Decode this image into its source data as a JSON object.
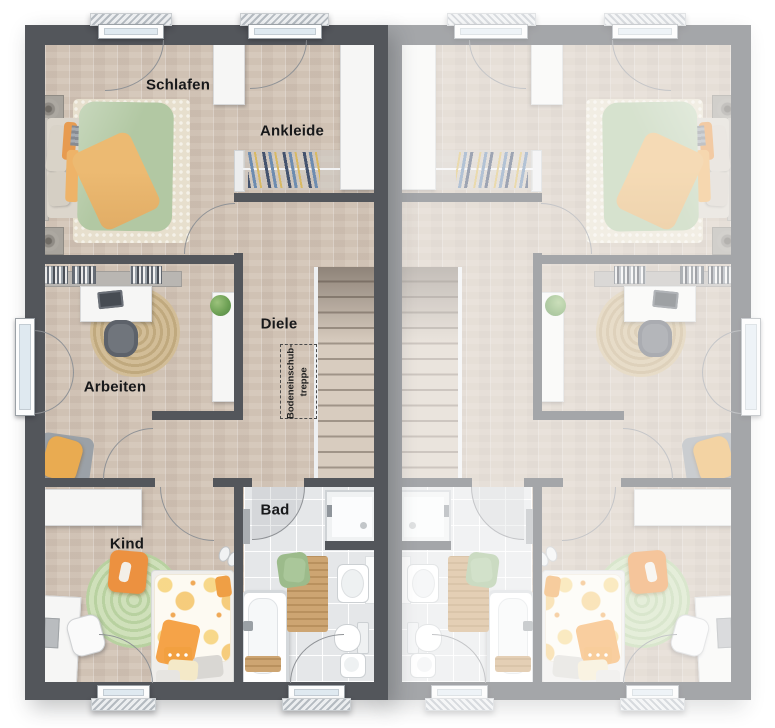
{
  "plan": {
    "room_labels": {
      "schlafen": "Schlafen",
      "ankleide": "Ankleide",
      "diele": "Diele",
      "arbeiten": "Arbeiten",
      "bad": "Bad",
      "kind": "Kind"
    },
    "attic_hatch": {
      "line1": "Bodeneinschub-",
      "line2": "treppe"
    },
    "colors": {
      "wall_dark": "#53565b",
      "wall_light_mirrored_unit": "#a6a9ac",
      "floor_wood": "#d6c9bc",
      "floor_tile": "#e5e7e9",
      "duvet_green": "#b2c8a3",
      "blanket_orange": "#ecba72",
      "rug_green": "#c6d9ae",
      "rug_jute": "#ccb68f",
      "rug_cream": "#e7dfcd",
      "kids_accent_orange": "#f0a24a",
      "window_glass": "#dfe9f0"
    }
  }
}
